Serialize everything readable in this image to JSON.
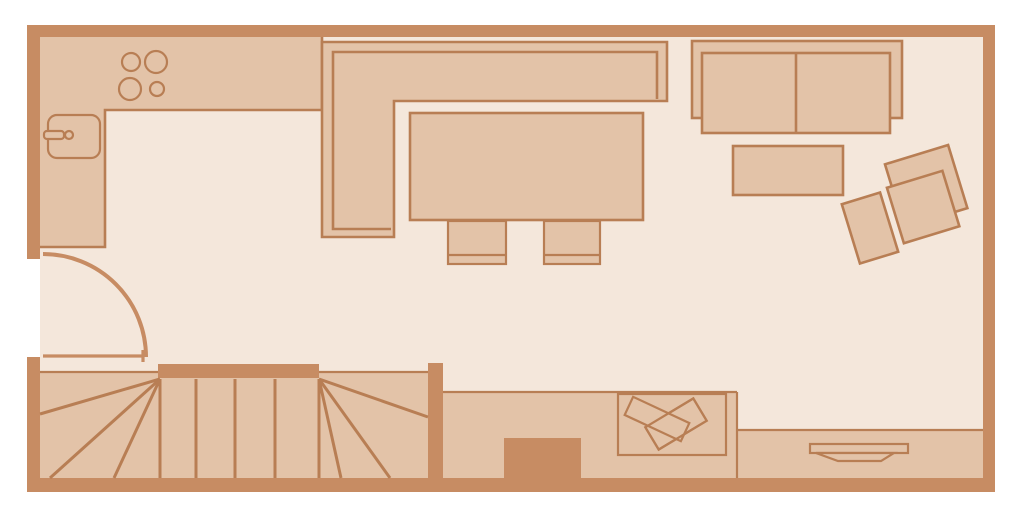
{
  "palette": {
    "bg": "#ffffff",
    "wall": "#c78c63",
    "furniture": "#e3c3a8",
    "floor": "#f4e7db",
    "outline": "#b87e54"
  },
  "plan": {
    "type": "apartment-floor-plan",
    "areas": [
      {
        "name": "kitchen",
        "items": [
          "l-shaped-counter",
          "stove-with-4-burners",
          "sink-with-tap"
        ]
      },
      {
        "name": "dining-area",
        "items": [
          "corner-bench",
          "dining-table",
          "dining-chair",
          "dining-chair"
        ]
      },
      {
        "name": "living-area",
        "items": [
          "two-seat-sofa",
          "coffee-table",
          "armchair",
          "ottoman"
        ]
      },
      {
        "name": "entry",
        "items": [
          "entry-door-with-swing-arc"
        ]
      },
      {
        "name": "staircase",
        "items": [
          "u-shaped-winder-stairs"
        ]
      },
      {
        "name": "bottom-strip",
        "items": [
          "chimney-block",
          "desk-with-papers",
          "tv-on-sideboard"
        ]
      }
    ],
    "counts": {
      "burners": 4,
      "dining-chairs": 2,
      "sofa-seats": 2,
      "straight-stair-treads": 4
    }
  }
}
